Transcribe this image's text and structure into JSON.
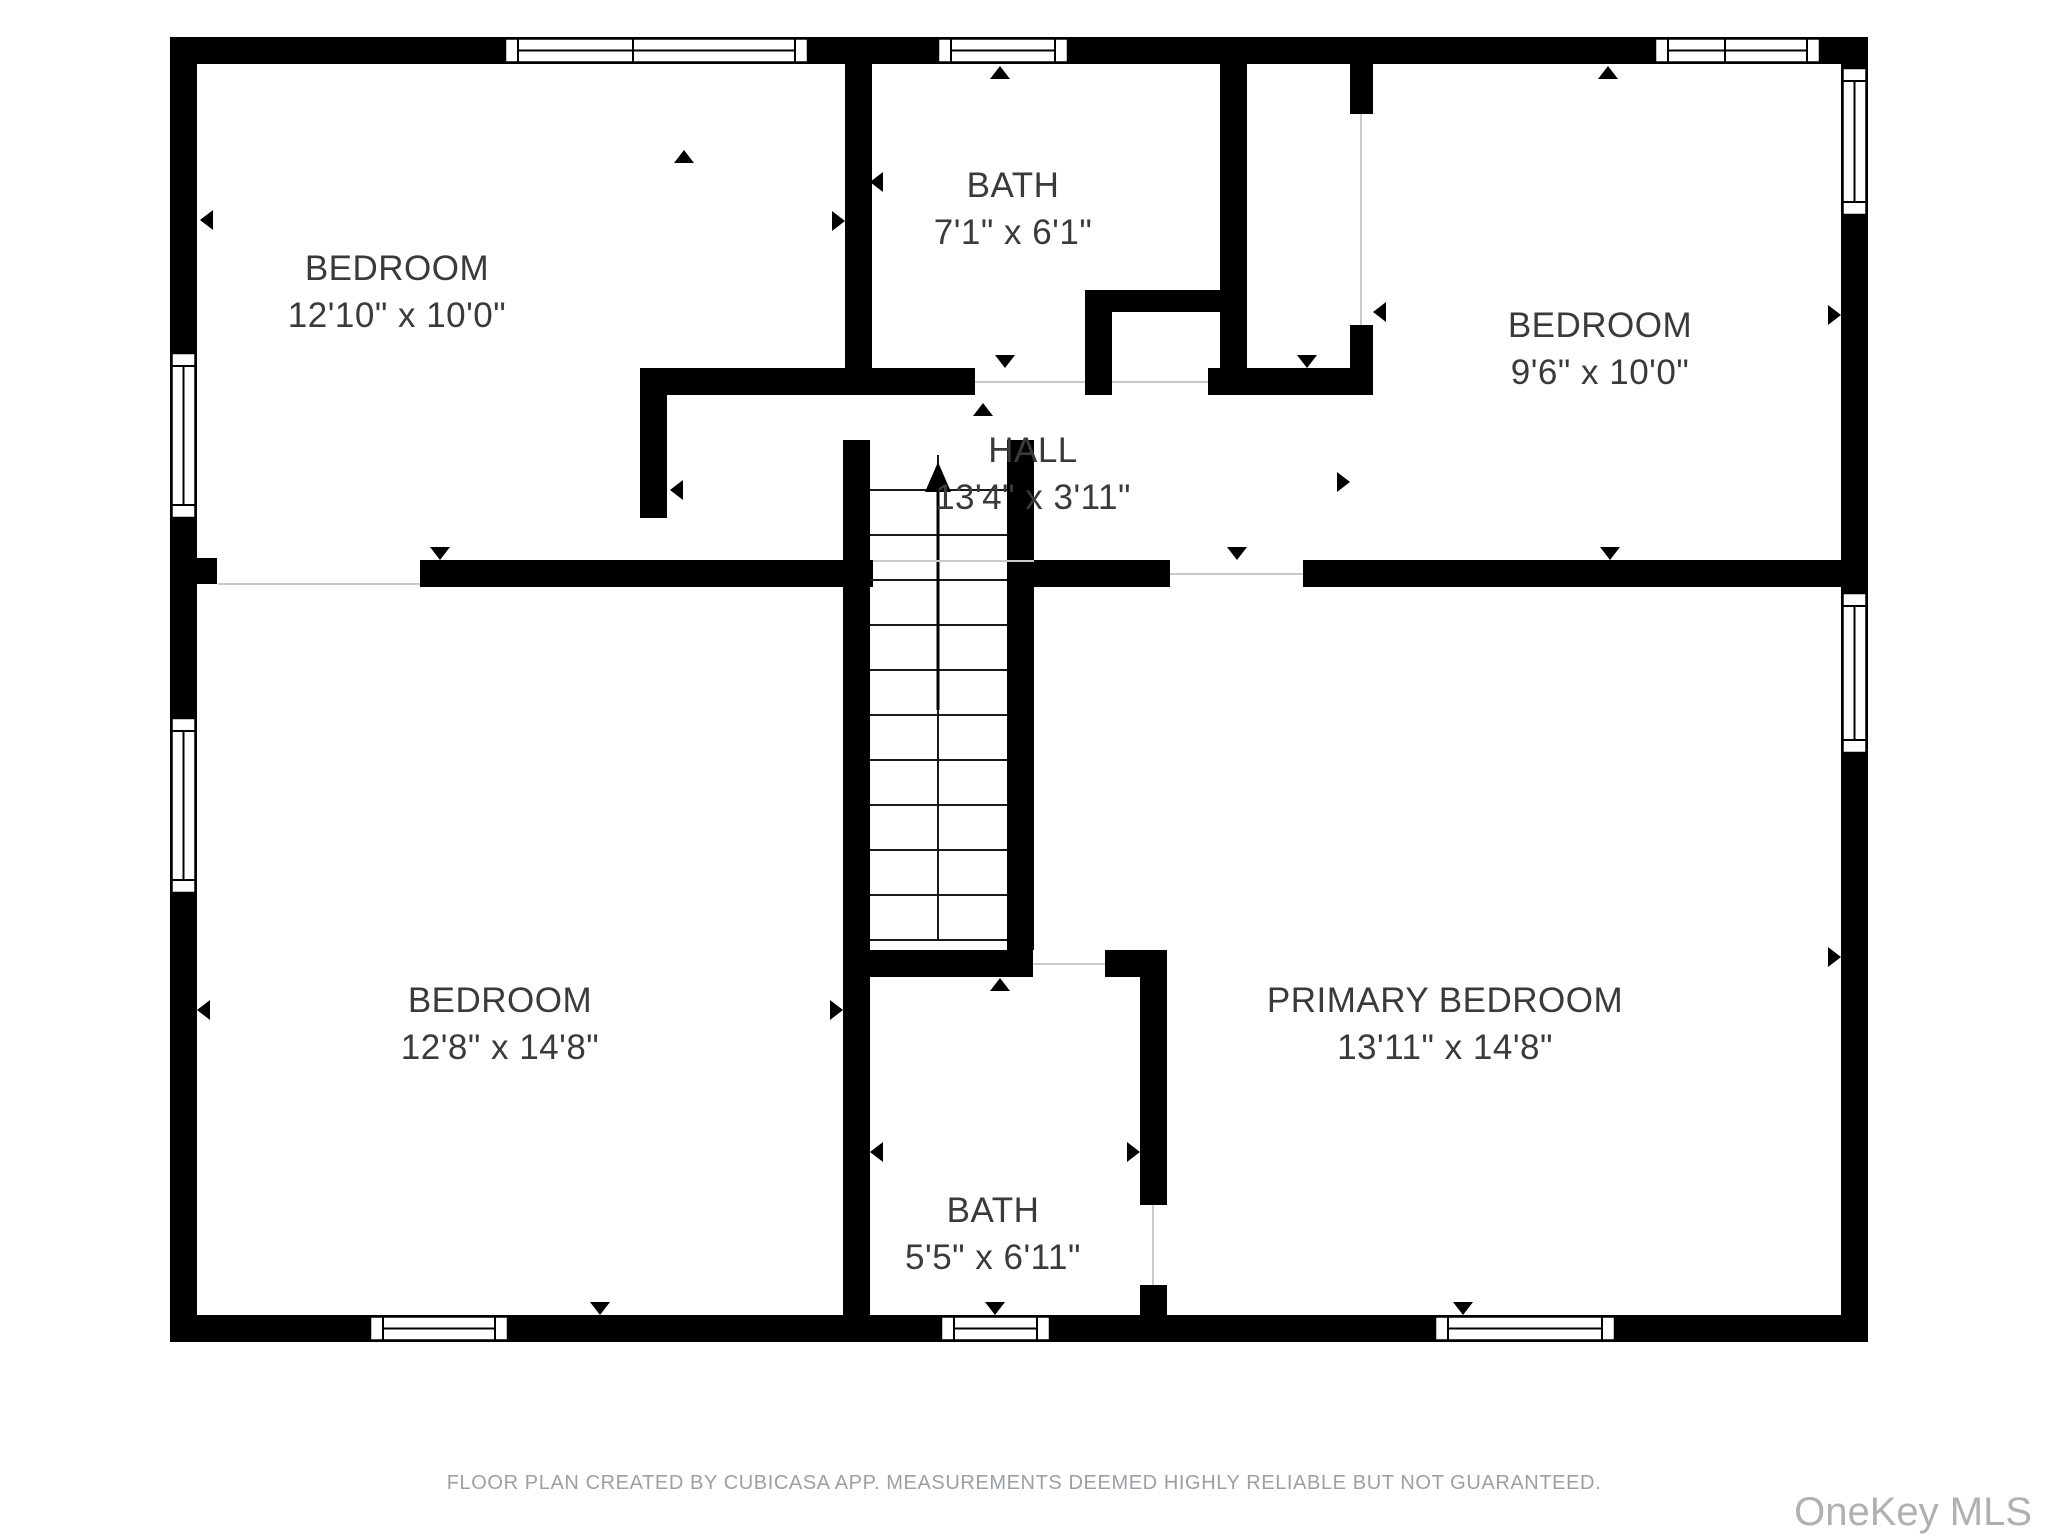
{
  "plan": {
    "background": "#ffffff",
    "wall_color": "#000000",
    "label_color": "#3a3a3a",
    "opening_line_color": "#c9c9c9",
    "rooms": [
      {
        "name": "BEDROOM",
        "dims": "12'10\" x 10'0\"",
        "cx": 397,
        "cy": 268
      },
      {
        "name": "BATH",
        "dims": "7'1\" x 6'1\"",
        "cx": 1013,
        "cy": 185
      },
      {
        "name": "BEDROOM",
        "dims": "9'6\" x 10'0\"",
        "cx": 1600,
        "cy": 325
      },
      {
        "name": "HALL",
        "dims": "13'4\" x 3'11\"",
        "cx": 1033,
        "cy": 450
      },
      {
        "name": "BEDROOM",
        "dims": "12'8\" x 14'8\"",
        "cx": 500,
        "cy": 1000
      },
      {
        "name": "BATH",
        "dims": "5'5\" x 6'11\"",
        "cx": 993,
        "cy": 1210
      },
      {
        "name": "PRIMARY BEDROOM",
        "dims": "13'11\" x 14'8\"",
        "cx": 1445,
        "cy": 1000
      }
    ],
    "walls": [
      [
        170,
        37,
        27,
        1305
      ],
      [
        170,
        37,
        1698,
        27
      ],
      [
        1841,
        37,
        27,
        1305
      ],
      [
        170,
        1315,
        1698,
        27
      ],
      [
        845,
        64,
        27,
        304
      ],
      [
        640,
        368,
        335,
        27
      ],
      [
        640,
        368,
        27,
        150
      ],
      [
        1085,
        290,
        27,
        105
      ],
      [
        1085,
        290,
        135,
        22
      ],
      [
        1220,
        64,
        27,
        331
      ],
      [
        1208,
        368,
        144,
        27
      ],
      [
        1350,
        64,
        23,
        50
      ],
      [
        1350,
        325,
        23,
        70
      ],
      [
        197,
        558,
        20,
        26
      ],
      [
        420,
        560,
        453,
        27
      ],
      [
        1034,
        560,
        136,
        27
      ],
      [
        1303,
        560,
        538,
        27
      ],
      [
        843,
        440,
        27,
        875
      ],
      [
        1007,
        440,
        27,
        510
      ],
      [
        843,
        950,
        190,
        27
      ],
      [
        1105,
        950,
        62,
        27
      ],
      [
        1140,
        950,
        27,
        255
      ],
      [
        1140,
        1285,
        27,
        30
      ]
    ],
    "windows": [
      {
        "side": "h",
        "x1": 505,
        "x2": 808,
        "y": 37,
        "div": [
          633
        ]
      },
      {
        "side": "h",
        "x1": 938,
        "x2": 1068,
        "y": 37,
        "div": []
      },
      {
        "side": "h",
        "x1": 1655,
        "x2": 1820,
        "y": 37,
        "div": [
          1725
        ]
      },
      {
        "side": "v",
        "y1": 68,
        "y2": 215,
        "x": 1841,
        "div": []
      },
      {
        "side": "v",
        "y1": 593,
        "y2": 753,
        "x": 1841,
        "div": []
      },
      {
        "side": "v",
        "y1": 353,
        "y2": 518,
        "x": 170,
        "div": []
      },
      {
        "side": "v",
        "y1": 718,
        "y2": 893,
        "x": 170,
        "div": []
      },
      {
        "side": "h",
        "x1": 370,
        "x2": 508,
        "y": 1315,
        "div": []
      },
      {
        "side": "h",
        "x1": 941,
        "x2": 1050,
        "y": 1315,
        "div": []
      },
      {
        "side": "h",
        "x1": 1435,
        "x2": 1615,
        "y": 1315,
        "div": []
      }
    ],
    "opening_lines": [
      [
        218,
        584,
        420,
        584
      ],
      [
        975,
        382,
        1085,
        382
      ],
      [
        1112,
        382,
        1208,
        382
      ],
      [
        1170,
        574,
        1303,
        574
      ],
      [
        873,
        561,
        1034,
        561
      ],
      [
        1033,
        964,
        1105,
        964
      ],
      [
        1361,
        114,
        1361,
        325
      ],
      [
        1153,
        1205,
        1153,
        1285
      ]
    ],
    "markers": [
      {
        "x": 684,
        "y": 150,
        "d": "up"
      },
      {
        "x": 1000,
        "y": 66,
        "d": "up"
      },
      {
        "x": 1608,
        "y": 66,
        "d": "up"
      },
      {
        "x": 200,
        "y": 220,
        "d": "left"
      },
      {
        "x": 845,
        "y": 221,
        "d": "right"
      },
      {
        "x": 870,
        "y": 182,
        "d": "left"
      },
      {
        "x": 1005,
        "y": 368,
        "d": "down"
      },
      {
        "x": 983,
        "y": 403,
        "d": "up"
      },
      {
        "x": 1307,
        "y": 368,
        "d": "down"
      },
      {
        "x": 1373,
        "y": 312,
        "d": "left"
      },
      {
        "x": 1350,
        "y": 482,
        "d": "right"
      },
      {
        "x": 1841,
        "y": 315,
        "d": "right"
      },
      {
        "x": 1610,
        "y": 560,
        "d": "down"
      },
      {
        "x": 440,
        "y": 560,
        "d": "down"
      },
      {
        "x": 670,
        "y": 490,
        "d": "left"
      },
      {
        "x": 197,
        "y": 1010,
        "d": "left"
      },
      {
        "x": 843,
        "y": 1010,
        "d": "right"
      },
      {
        "x": 870,
        "y": 1152,
        "d": "left"
      },
      {
        "x": 1140,
        "y": 1152,
        "d": "right"
      },
      {
        "x": 1000,
        "y": 978,
        "d": "up"
      },
      {
        "x": 1237,
        "y": 560,
        "d": "down"
      },
      {
        "x": 600,
        "y": 1315,
        "d": "down"
      },
      {
        "x": 995,
        "y": 1315,
        "d": "down"
      },
      {
        "x": 1463,
        "y": 1315,
        "d": "down"
      },
      {
        "x": 1841,
        "y": 957,
        "d": "right"
      }
    ],
    "stairs": {
      "x1": 870,
      "x2": 1007,
      "divider": 938,
      "top": 455,
      "bottom": 940,
      "tread_ys": [
        490,
        535,
        580,
        625,
        670,
        715,
        760,
        805,
        850,
        895
      ],
      "arrow": {
        "x": 938,
        "y_tail": 710,
        "y_tip": 462
      }
    }
  },
  "footer": {
    "disclaimer": "FLOOR PLAN CREATED BY CUBICASA APP. MEASUREMENTS DEEMED HIGHLY RELIABLE BUT NOT GUARANTEED."
  },
  "watermark": {
    "text": "OneKey MLS"
  }
}
